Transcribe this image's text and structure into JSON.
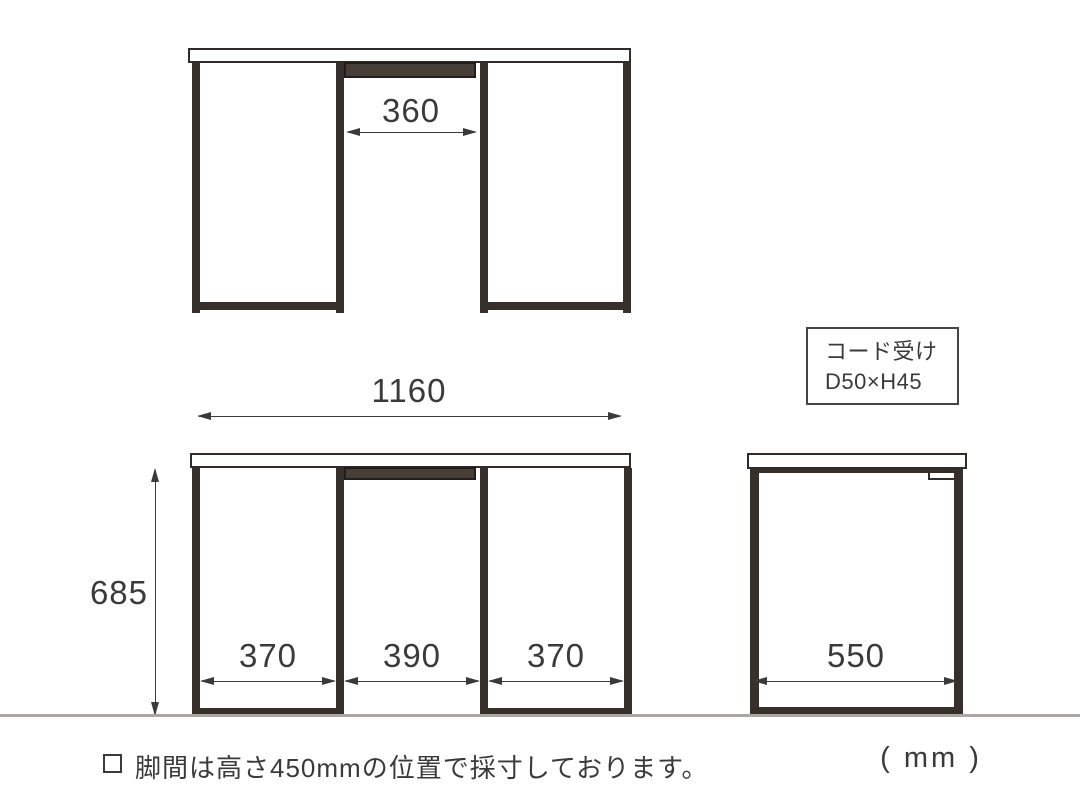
{
  "drawing": {
    "title_semantics": "desk dimension diagram",
    "unit_label": "( mm )",
    "note": {
      "text": "脚間は高さ450mmの位置で採寸しております。"
    },
    "top_view": {
      "center_gap_dim": "360"
    },
    "front_view": {
      "width_dim": "1160",
      "height_dim": "685",
      "left_gap_dim": "370",
      "center_gap_dim": "390",
      "right_gap_dim": "370"
    },
    "side_view": {
      "depth_dim": "550",
      "label_box": {
        "line1": "コード受け",
        "line2": "D50×H45"
      }
    },
    "colors": {
      "line": "#3a3a3a",
      "leg_fill": "#362f2b",
      "cord_bar_fill": "#473e37",
      "floor_line": "#aaa7a4",
      "background": "#ffffff"
    }
  }
}
